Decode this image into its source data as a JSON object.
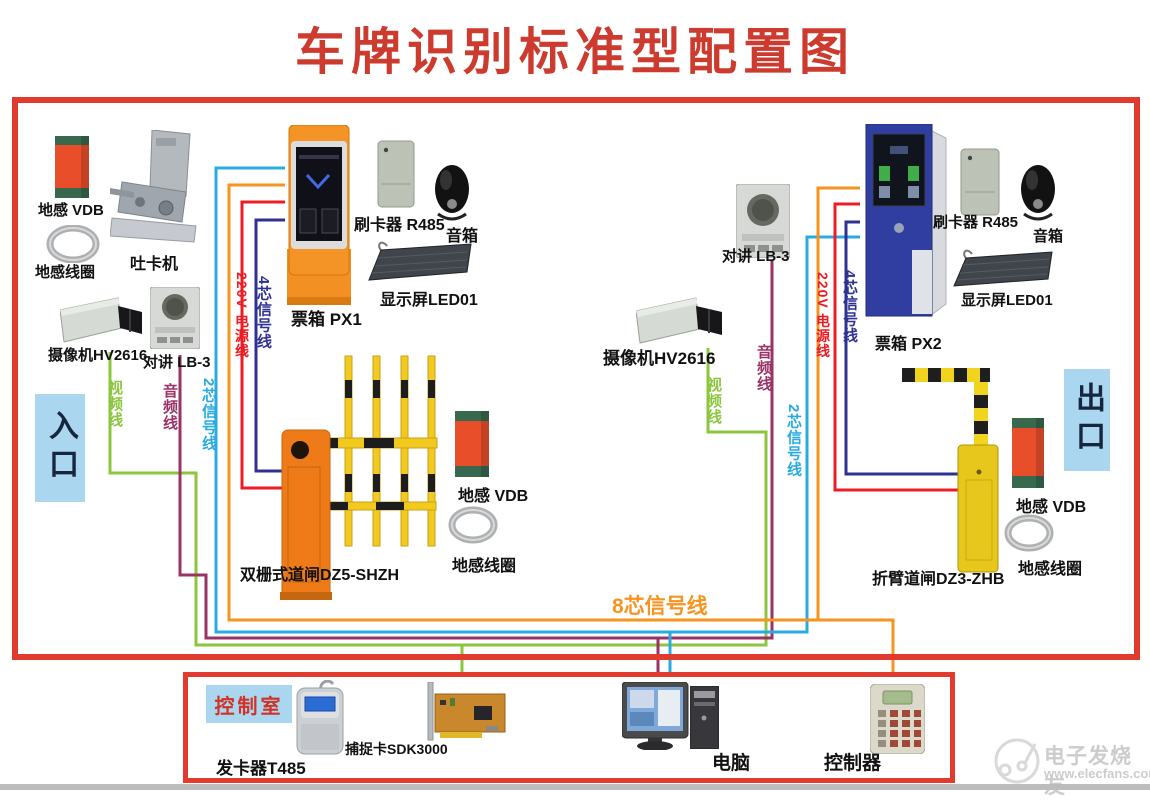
{
  "title": "车牌识别标准型配置图",
  "zones": {
    "entrance": "入口",
    "exit": "出口",
    "control_room": "控制室"
  },
  "devices": {
    "vdb": "地感 VDB",
    "loop_coil": "地感线圈",
    "card_dispenser": "吐卡机",
    "camera": "摄像机HV2616",
    "intercom": "对讲 LB-3",
    "ticket_box_1": "票箱 PX1",
    "ticket_box_2": "票箱 PX2",
    "card_reader": "刷卡器 R485",
    "speaker": "音箱",
    "led_display": "显示屏LED01",
    "barrier_entrance": "双栅式道闸DZ5-SHZH",
    "barrier_exit": "折臂道闸DZ3-ZHB",
    "card_issuer": "发卡器T485",
    "capture_card": "捕捉卡SDK3000",
    "computer": "电脑",
    "controller": "控制器"
  },
  "wires": {
    "power_220v": {
      "label": "220V 电源线",
      "color": "#ED1C24"
    },
    "signal_4core": {
      "label": "4芯信号线",
      "color": "#2E3192"
    },
    "signal_2core": {
      "label": "2芯信号线",
      "color": "#29ABE2"
    },
    "signal_8core": {
      "label": "8芯信号线",
      "color": "#F7931E"
    },
    "audio": {
      "label": "音频线",
      "color": "#993366"
    },
    "video": {
      "label": "视频线",
      "color": "#8CC63F"
    }
  },
  "frame_color": "#E23B2E",
  "zone_background": "#AAD6EF",
  "watermark": {
    "brand": "电子发烧友",
    "url": "www.elecfans.com"
  }
}
